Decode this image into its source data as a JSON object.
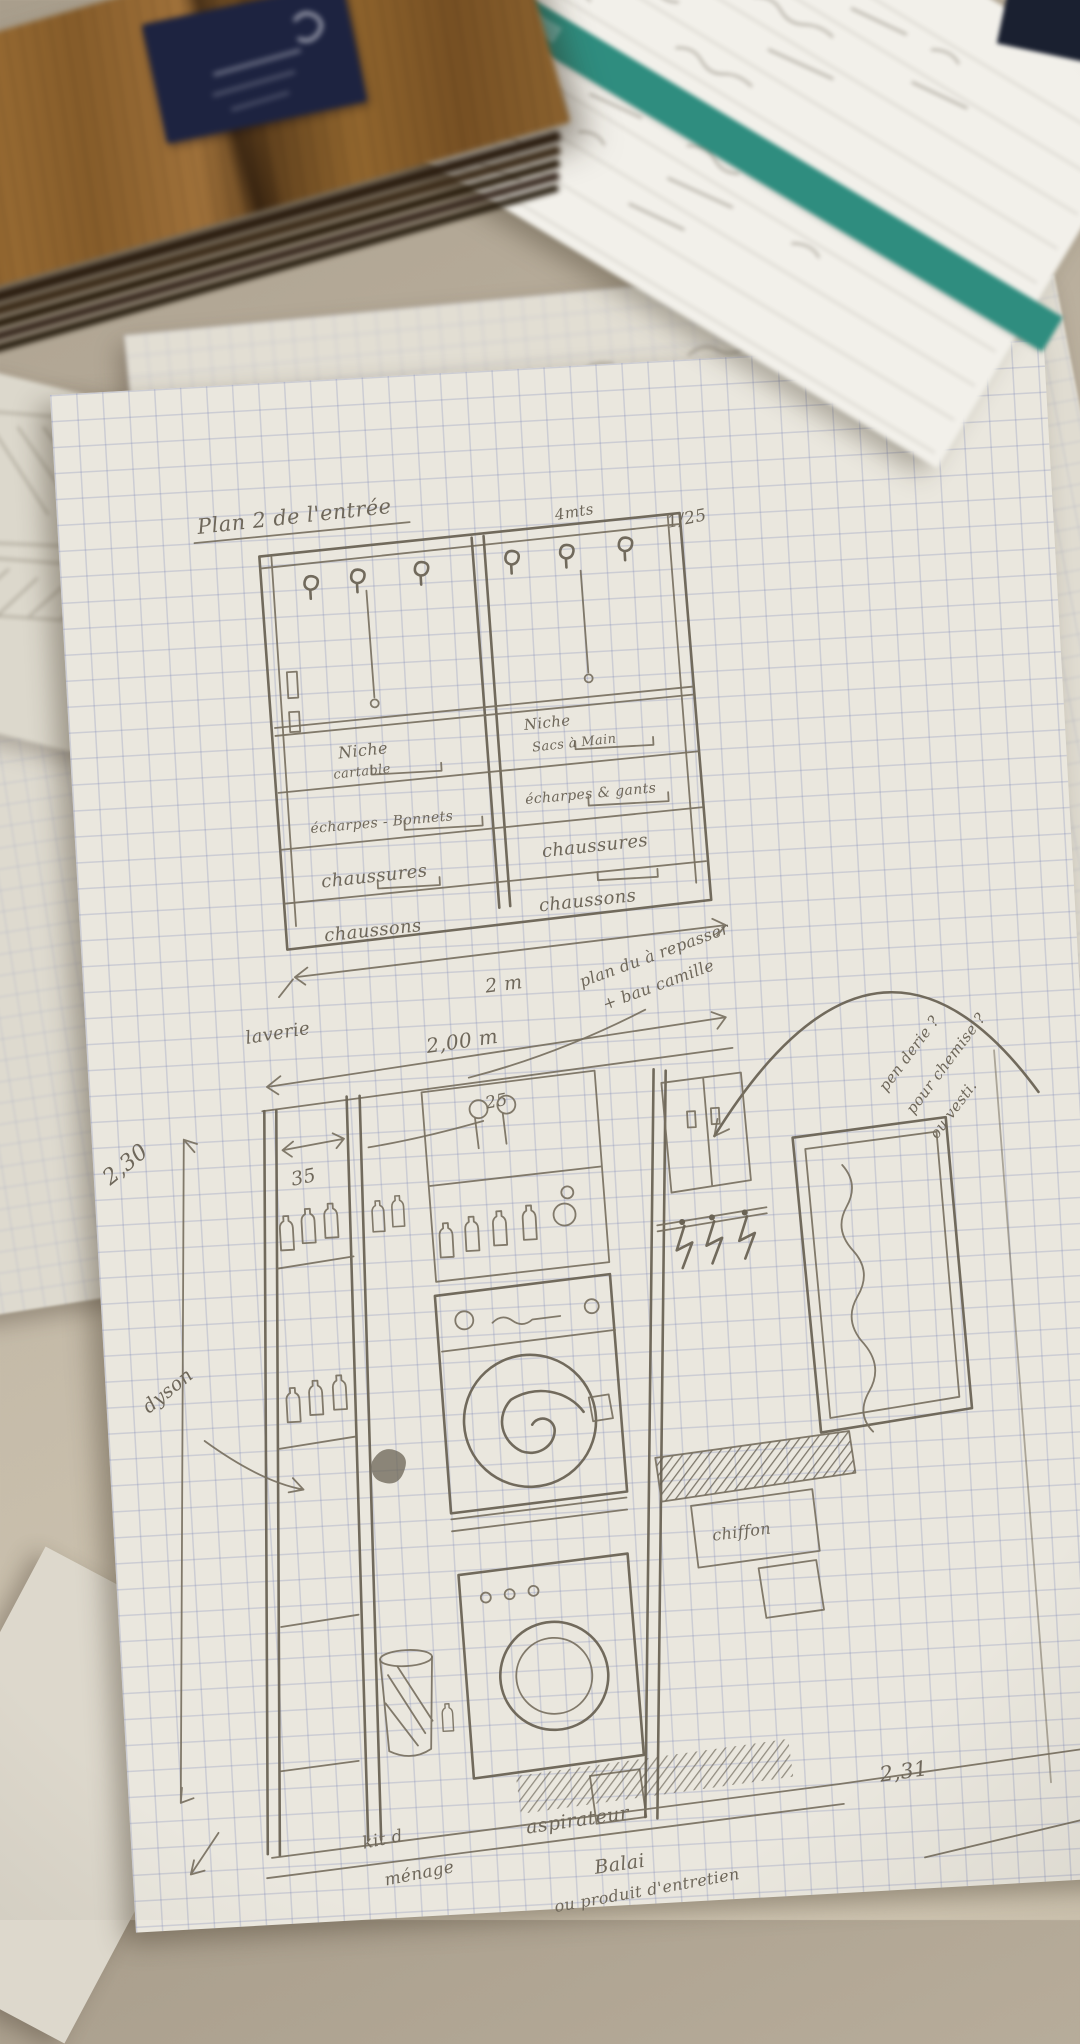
{
  "colors": {
    "form_teal": "#2f8d7f",
    "label_navy": "#1d2340",
    "wood_brown": "#96682f",
    "pencil_grey": "#77705f",
    "grid_blue": "#97a0c6",
    "table_beige": "#bfb4a1"
  },
  "upper": {
    "title": "Plan 2 de l'entrée",
    "note": "4mts",
    "scale": "1/25",
    "left": {
      "niche1": "Niche",
      "niche2": "cartable",
      "row2": "écharpes - Bonnets",
      "row3": "chaussures",
      "row4": "chaussons"
    },
    "right": {
      "niche1": "Niche",
      "niche2": "Sacs à Main",
      "row2": "écharpes & gants",
      "row3": "chaussures",
      "row4": "chaussons"
    },
    "width_dim": "2 m"
  },
  "lower": {
    "room": "laverie",
    "width": "2,00 m",
    "iron1": "plan du à repasser",
    "iron2": "+ bau camille",
    "pend1": "pen derie ?",
    "pend2": "pour chemise ?",
    "pend3": "ou vesti.",
    "height": "2,30",
    "vacuum": "dyson",
    "d35": "35",
    "d25": "25",
    "cloth": "chiffon",
    "vacuum2": "aspirateur",
    "broom": "Balai",
    "products": "ou produit d'entretien",
    "width2": "2,31",
    "house1": "kit d",
    "house2": "ménage"
  }
}
